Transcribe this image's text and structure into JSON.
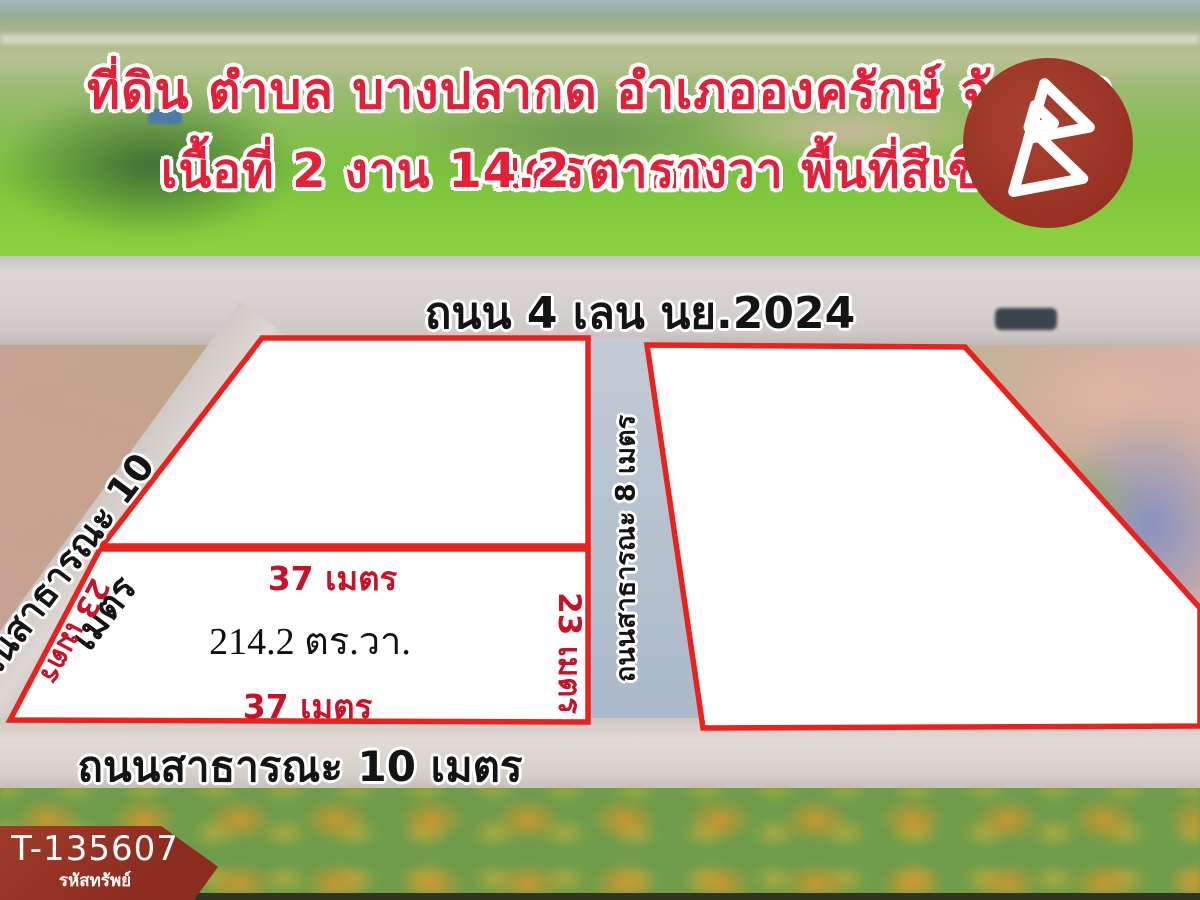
{
  "header": {
    "title_line1": "ที่ดิน ตำบล บางปลากด อำเภอองครักษ์ จังหวัดนครนายก",
    "title_line2": "เนื้อที่ 2 งาน 14.2 ตารางวา พื้นที่สีเขียว"
  },
  "roads": {
    "main_road": "ถนน 4 เลน นย.2024",
    "left_road": "ถนนสาธารณะ 10 เมตร",
    "center_road": "ถนนสาธารณะ 8 เมตร",
    "bottom_road": "ถนนสาธารณะ 10 เมตร"
  },
  "plots": {
    "middle_plot": {
      "top_width": "37 เมตร",
      "bottom_width": "37 เมตร",
      "left_depth": "23 เมตร",
      "right_depth": "23 เมตร",
      "area": "214.2 ตร.วา."
    }
  },
  "badge": {
    "code": "T-135607",
    "label": "รหัสทรัพย์"
  },
  "icons": {
    "logo": "b-triangles-icon"
  },
  "colors": {
    "plot_border_red": "#ea211c",
    "title_red": "#e32038",
    "dimension_red": "#c81228",
    "logo_maroon": "#962f20",
    "badge_maroon": "#8c2c20"
  }
}
